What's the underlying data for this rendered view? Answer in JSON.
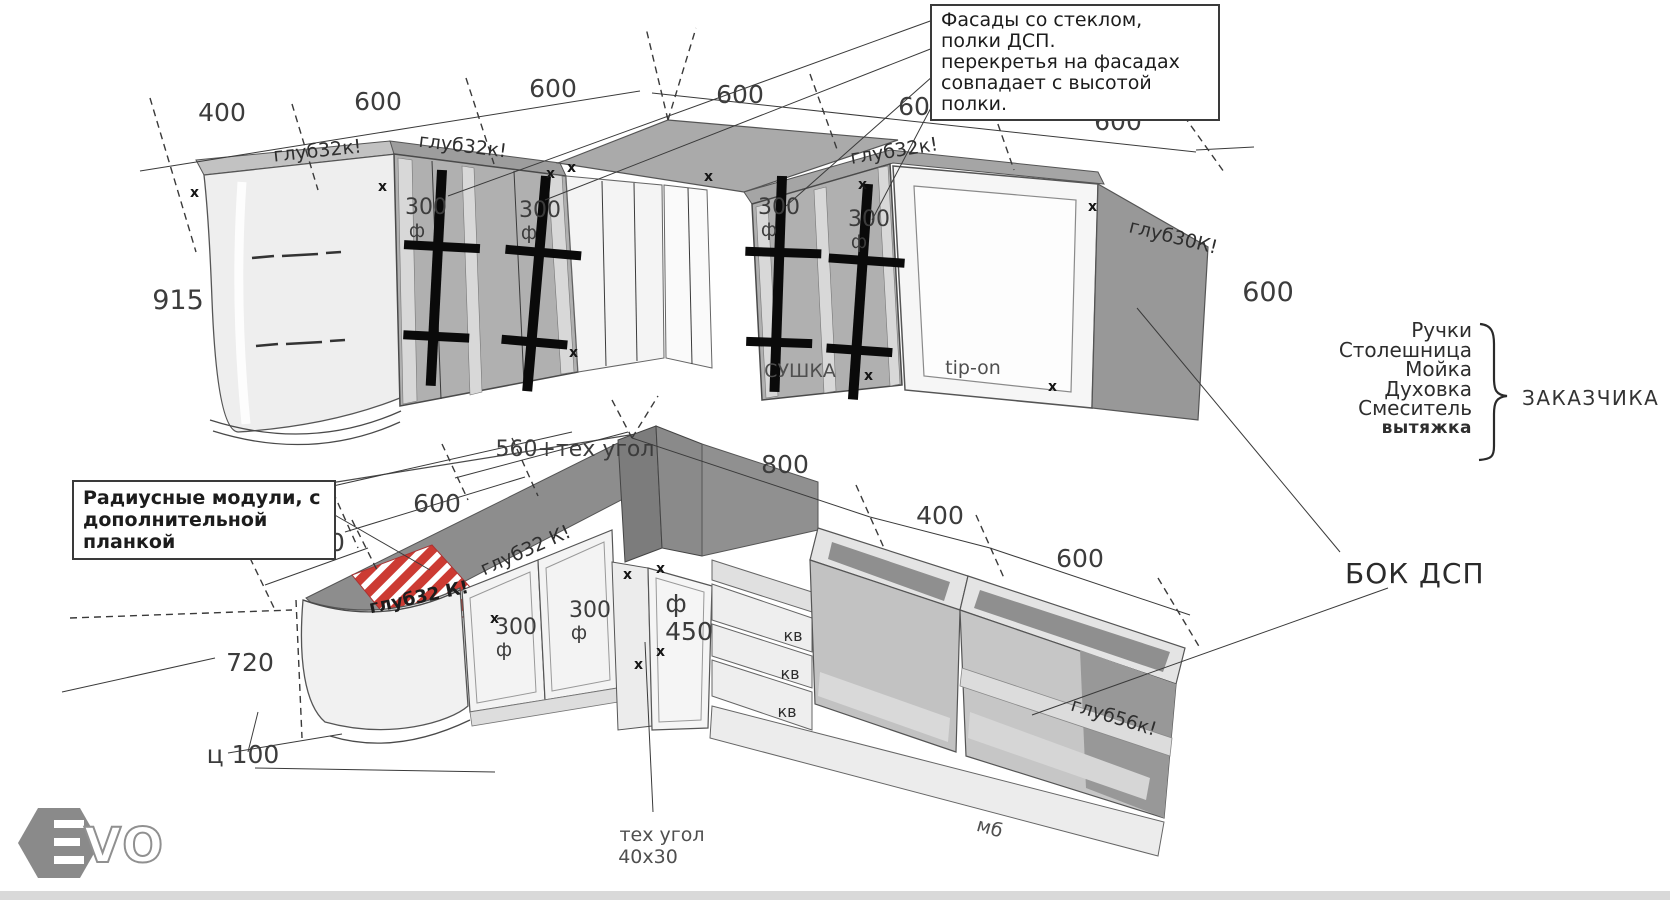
{
  "notes": {
    "glass": "Фасады со стеклом,\nполки ДСП.\nперекретья на фасадах\nсовпадает с высотой\nполки.",
    "radius": "Радиусные модули, с\nдополнительной\nпланкой"
  },
  "customer": {
    "items": [
      "Ручки",
      "Столешница",
      "Мойка",
      "Духовка",
      "Смеситель",
      "вытяжка"
    ],
    "label": "ЗАКАЗЧИКА"
  },
  "bok_dsp": "БОК ДСП",
  "dims": {
    "top": [
      "400",
      "600",
      "600",
      "600",
      "600",
      "600"
    ],
    "upper_height_left": "915",
    "upper_height_right": "600",
    "lower_corner": "560+тех угол",
    "lower_left_600": "600",
    "lower_left_400": "400",
    "lower_chain": [
      "800",
      "400",
      "600"
    ],
    "lower_height": "720",
    "plinth": "ц 100"
  },
  "depths": {
    "upper_1": "глуб32к!",
    "upper_2": "глуб32к!",
    "upper_3": "глуб32к!",
    "upper_right": "глуб30К!",
    "counter": "глуб32 К!",
    "hatch": "глуб32 К!",
    "lower_right": "глуб56к!"
  },
  "doors": {
    "w300": "300",
    "flag": "ф",
    "w450": "450",
    "drawer": "кв",
    "sushka": "СУШКА",
    "tip_on": "tip-on",
    "mb": "мб",
    "tech_corner_1": "тех угол",
    "tech_corner_2": "40х30"
  },
  "markers": {
    "x": "х"
  },
  "logo": {
    "vo": "VO"
  },
  "colors": {
    "hatch_red": "#cc3b33",
    "panel_dark": "#8d8d8d",
    "glass_panel": "#b0b0b0"
  }
}
